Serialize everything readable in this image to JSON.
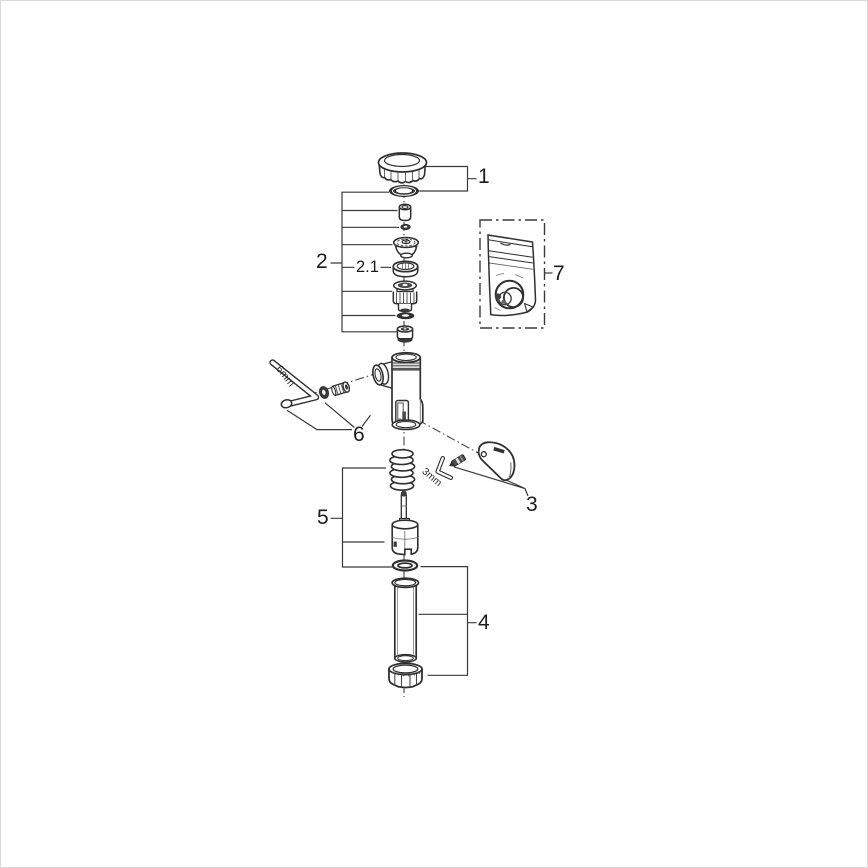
{
  "page": {
    "background": "#ffffff",
    "line_color": "#2f2f2f"
  },
  "callouts": {
    "part1": "1",
    "part2": "2",
    "part2_sub": "2.1",
    "part3": "3",
    "part4": "4",
    "part5": "5",
    "part6": "6",
    "part7": "7"
  },
  "tool_labels": {
    "hex_key_6mm": "6mm",
    "hex_key_3mm": "3mm"
  }
}
